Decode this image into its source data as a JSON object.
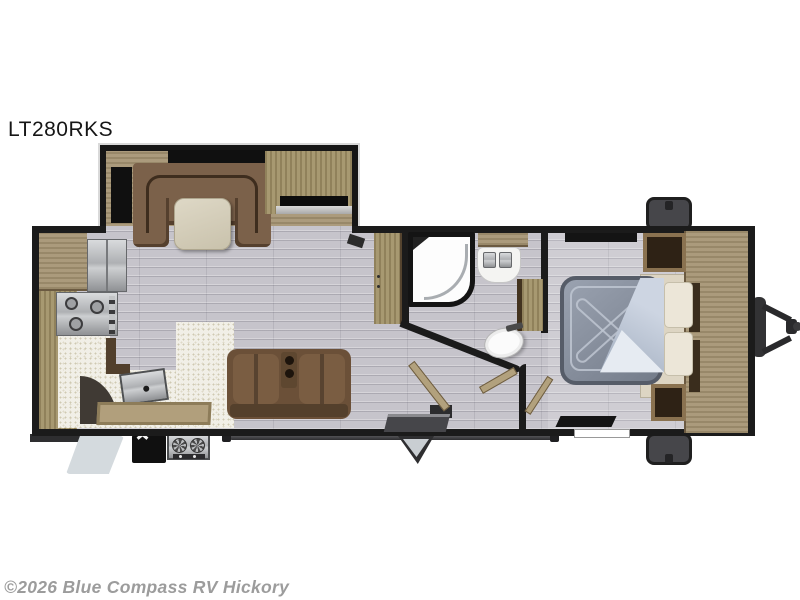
{
  "title": "LT280RKS",
  "watermark": "©2026 Blue Compass RV Hickory",
  "colors": {
    "wall": "#1b1b1b",
    "floor": "#c6c4cb",
    "counter": "#f1efe7",
    "wood": "#a89878",
    "wood_dark": "#6b5a41",
    "sofa": "#6b5038",
    "bed_mattress": "#8b93a3",
    "bed_sheet": "#c9d2df",
    "exterior_gray": "#46464a",
    "background": "#ffffff"
  }
}
